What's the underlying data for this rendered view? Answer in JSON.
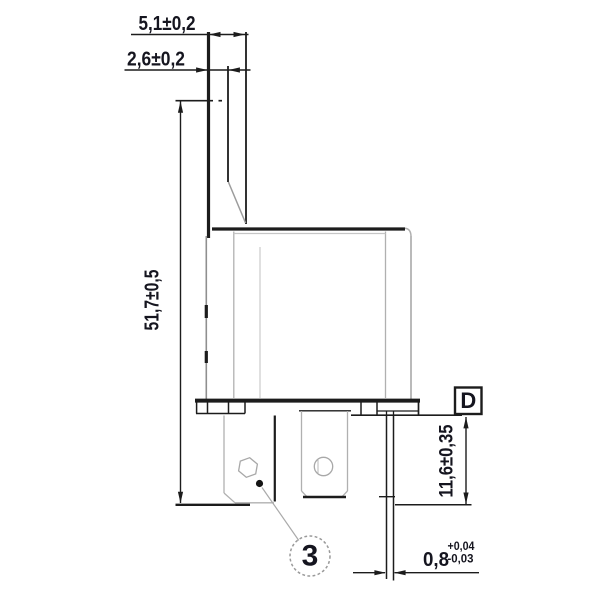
{
  "drawing_type": "technical-dimension-drawing",
  "component": "relay-side-view-with-mounting-bracket",
  "dimensions": {
    "bracket_top_width": "5,1±0,2",
    "bracket_thickness": "2,6±0,2",
    "overall_height": "51,7±0,5",
    "terminal_length": "11,6±0,35",
    "pin_thickness": {
      "value": "0,8",
      "tol_plus": "+0,04",
      "tol_minus": "-0,03"
    }
  },
  "callouts": {
    "detail_label": "D",
    "position_number": "3"
  },
  "colors": {
    "line": "#1c1c1c",
    "light_line": "#b0b0b0",
    "text": "#15151f",
    "background": "#ffffff"
  }
}
